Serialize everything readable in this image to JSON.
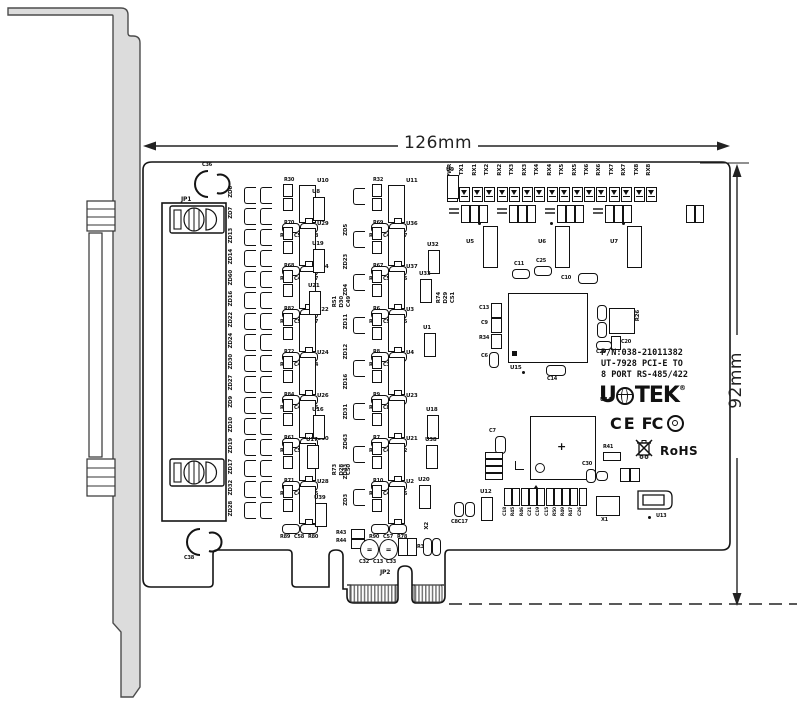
{
  "dimensions": {
    "width": "126mm",
    "height": "92mm"
  },
  "title_block": {
    "pn": "P/N:038-21011382",
    "line2": "UT-7928 PCI-E TO",
    "line3": "8 PORT RS-485/422"
  },
  "brand": {
    "left": "U",
    "right": "TEK",
    "reg": "®"
  },
  "certs": {
    "ce": "CE",
    "fcc": "FC",
    "rohs": "RoHS"
  },
  "labels": {
    "jp1": "JP1",
    "jp2": "JP2",
    "x1": "X1",
    "x2": "X2",
    "c36": "C36",
    "c38": "C38",
    "c8c17": "C8C17",
    "u5": "U5",
    "u6": "U6",
    "u7": "U7",
    "u12": "U12",
    "u13": "U13",
    "u14": "U14",
    "u15": "U15",
    "c11": "C11",
    "c25": "C25",
    "c10": "C10",
    "c14": "C14",
    "c29": "C29",
    "c20": "C20",
    "c30": "C30",
    "c13": "C13",
    "c9": "C9",
    "r34": "R34",
    "c6": "C6",
    "r26": "R26",
    "c7": "C7",
    "r41": "R41",
    "r43": "R43",
    "r44": "R44",
    "r38": "R38",
    "c32": "C32",
    "c13b": "C13",
    "c33": "C33",
    "plus": "+"
  },
  "leds": [
    "PWR",
    "TX1",
    "RX1",
    "TX2",
    "RX2",
    "TX3",
    "RX3",
    "TX4",
    "RX4",
    "TX5",
    "RX5",
    "TX6",
    "RX6",
    "TX7",
    "RX7",
    "TX8",
    "RX8"
  ],
  "zd_left": [
    "ZD6",
    "ZD7",
    "ZD13",
    "ZD14",
    "ZD60",
    "ZD16",
    "ZD22",
    "ZD24",
    "ZD30",
    "ZD27",
    "ZD9",
    "ZD10",
    "ZD19",
    "ZD17",
    "ZD32",
    "ZD28"
  ],
  "zd_mid": [
    "ZD5",
    "ZD23",
    "ZD4",
    "ZD11",
    "ZD12",
    "ZD16",
    "ZD31",
    "ZD63",
    "ZD43",
    "ZD3"
  ],
  "channels_a": [
    {
      "rtop": "R30",
      "ic": "U10",
      "c": [
        "R29",
        "C5",
        "R28"
      ]
    },
    {
      "rtop": "R70",
      "ic": "U29",
      "c": [
        "R66",
        "C46",
        "R57"
      ]
    },
    {
      "rtop": "R68",
      "ic": "U34",
      "c": [
        "R81",
        "C54",
        "R77"
      ]
    },
    {
      "rtop": "R82",
      "ic": "U22",
      "c": [
        "R64",
        "C45",
        "R54"
      ]
    },
    {
      "rtop": "R72",
      "ic": "U24",
      "c": [
        "R40",
        "C43",
        "R36"
      ]
    },
    {
      "rtop": "R84",
      "ic": "U26",
      "c": [
        "R85",
        "C52",
        "R73"
      ]
    },
    {
      "rtop": "R61",
      "ic": "U30",
      "c": [
        "R62",
        "C47",
        "R55"
      ]
    },
    {
      "rtop": "R71",
      "ic": "U28",
      "c": [
        "R89",
        "C58",
        "R80"
      ]
    }
  ],
  "channels_b": [
    {
      "rtop": "R32",
      "ic": "U11",
      "c": [
        "R31",
        "C4",
        "R27"
      ]
    },
    {
      "rtop": "R69",
      "ic": "U36",
      "c": [
        "R64",
        "C55",
        "R76"
      ]
    },
    {
      "rtop": "R67",
      "ic": "U37",
      "c": [
        "R63",
        "C53",
        "R75"
      ]
    },
    {
      "rtop": "R6",
      "ic": "U3",
      "c": [
        "R5",
        "C3",
        "R3"
      ]
    },
    {
      "rtop": "R8",
      "ic": "U4",
      "c": [
        "R4",
        "C8",
        "R2"
      ]
    },
    {
      "rtop": "R9",
      "ic": "U23",
      "c": [
        "R60",
        "C44",
        "R52"
      ]
    },
    {
      "rtop": "R7",
      "ic": "U21",
      "c": [
        "R59",
        "C48",
        "R56"
      ]
    },
    {
      "rtop": "R10",
      "ic": "U2",
      "c": [
        "R90",
        "C57",
        "R78"
      ]
    }
  ],
  "mid_ics": [
    {
      "t": "U8",
      "x": 312,
      "y": 190
    },
    {
      "t": "U19",
      "x": 312,
      "y": 242
    },
    {
      "t": "U21",
      "x": 308,
      "y": 284
    },
    {
      "t": "U16",
      "x": 312,
      "y": 408
    },
    {
      "t": "U17",
      "x": 306,
      "y": 438
    },
    {
      "t": "U39",
      "x": 314,
      "y": 496
    },
    {
      "t": "U9",
      "x": 446,
      "y": 168
    },
    {
      "t": "U32",
      "x": 427,
      "y": 243
    },
    {
      "t": "U33",
      "x": 419,
      "y": 272
    },
    {
      "t": "U1",
      "x": 423,
      "y": 326
    },
    {
      "t": "U18",
      "x": 426,
      "y": 408
    },
    {
      "t": "U38",
      "x": 425,
      "y": 438
    },
    {
      "t": "U20",
      "x": 418,
      "y": 478
    },
    {
      "t": "U12",
      "x": 480,
      "y": 490
    }
  ],
  "misc_vlabels": [
    {
      "t": "R51",
      "x": 333,
      "y": 296
    },
    {
      "t": "D30",
      "x": 340,
      "y": 296
    },
    {
      "t": "C49",
      "x": 347,
      "y": 296
    },
    {
      "t": "R74",
      "x": 437,
      "y": 292
    },
    {
      "t": "D29",
      "x": 444,
      "y": 292
    },
    {
      "t": "C51",
      "x": 451,
      "y": 292
    },
    {
      "t": "R73",
      "x": 333,
      "y": 464
    },
    {
      "t": "D28",
      "x": 340,
      "y": 464
    },
    {
      "t": "C50",
      "x": 347,
      "y": 464
    }
  ],
  "bottom_caps": [
    "C18",
    "R45",
    "R46",
    "C21",
    "C19",
    "C15",
    "R50",
    "R49",
    "R47",
    "C26"
  ]
}
